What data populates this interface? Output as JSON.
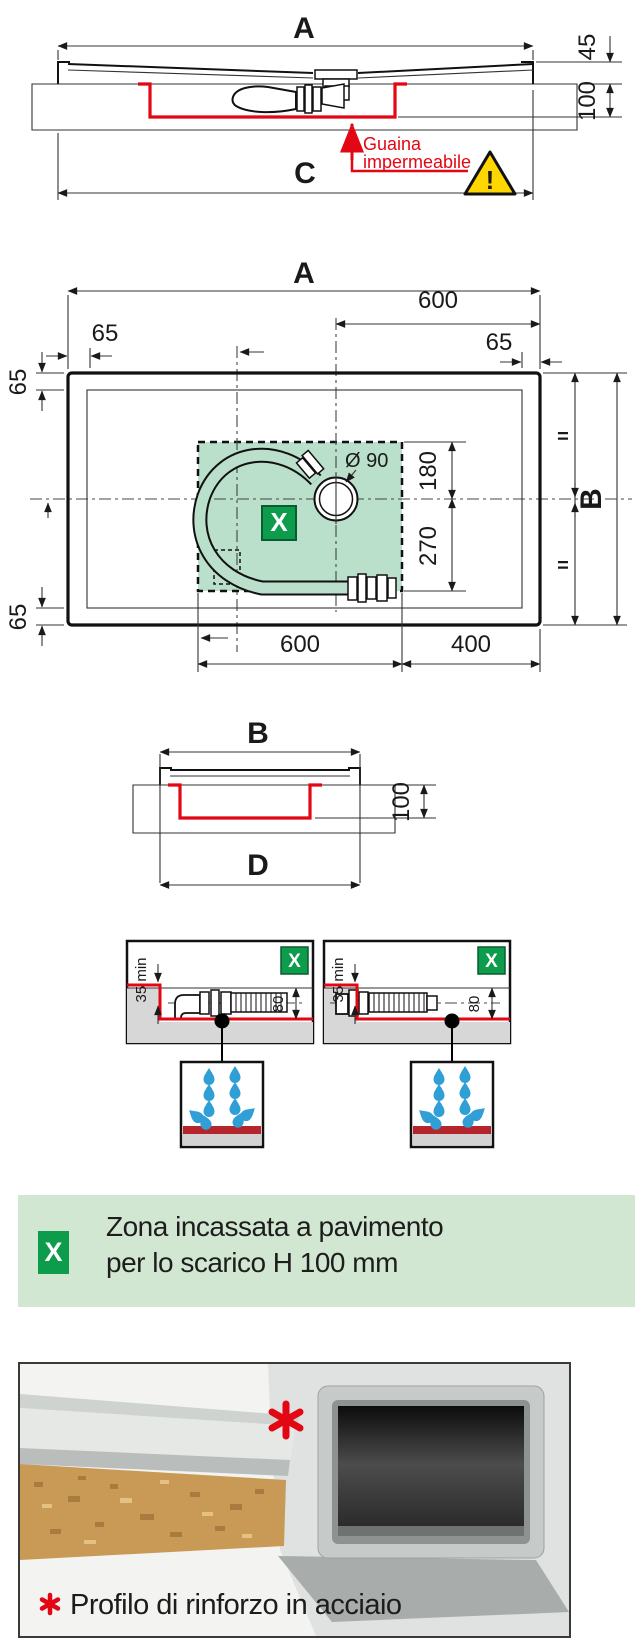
{
  "colors": {
    "red": "#e30613",
    "green_badge": "#0d9b4c",
    "zone_green": "#badfca",
    "banner_green": "#d2e7d1",
    "slab_gray": "#d7d7d7",
    "drop_blue": "#2f9fd6",
    "warning_yellow": "#ffd600"
  },
  "section_top": {
    "dim_a": "A",
    "dim_45": "45",
    "dim_100": "100",
    "dim_c": "C",
    "note_line1": "Guaina",
    "note_line2": "impermeabile",
    "warning_mark": "!"
  },
  "plan": {
    "dim_a": "A",
    "dim_600_top": "600",
    "dim_65_top_left": "65",
    "dim_65_top_right": "65",
    "dim_65_side_top": "65",
    "dim_65_side_bottom": "65",
    "drain_label": "Ø 90",
    "dim_180": "180",
    "dim_270": "270",
    "dim_b": "B",
    "equal_top": "=",
    "equal_bottom": "=",
    "zone_badge": "X",
    "dim_600_bottom": "600",
    "dim_400_bottom": "400"
  },
  "section_b": {
    "dim_b": "B",
    "dim_100": "100",
    "dim_d": "D"
  },
  "details": {
    "badge": "X",
    "dim_35": "35 min",
    "dim_80": "80"
  },
  "banner": {
    "badge": "X",
    "line1": "Zona incassata a pavimento",
    "line2": "per lo scarico H 100 mm"
  },
  "photo": {
    "caption": "Profilo di rinforzo in acciaio"
  }
}
